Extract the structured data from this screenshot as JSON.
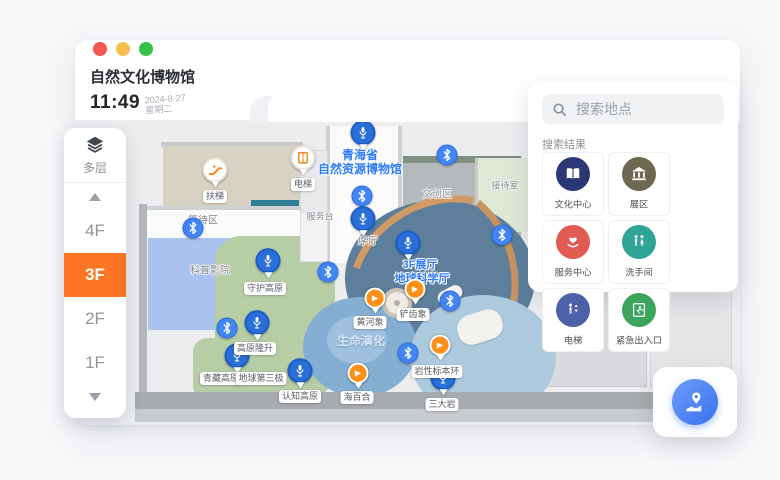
{
  "window": {
    "title": "自然文化博物馆",
    "time": "11:49",
    "date": "2024-8-27",
    "weekday": "星期二"
  },
  "floor_selector": {
    "layers_label": "多层",
    "floors": [
      "4F",
      "3F",
      "2F",
      "1F"
    ],
    "active_floor": "3F",
    "ghost_floor": "2F",
    "active_color": "#fd7522"
  },
  "search": {
    "placeholder": "搜索地点",
    "results_label": "搜索结果",
    "categories": [
      {
        "label": "文化中心",
        "icon": "book-icon",
        "color": "#2a3875"
      },
      {
        "label": "展区",
        "icon": "museum-icon",
        "color": "#6e6852"
      },
      {
        "label": "服务中心",
        "icon": "heart-hands-icon",
        "color": "#e25b52"
      },
      {
        "label": "洗手间",
        "icon": "restroom-icon",
        "color": "#2fa497"
      },
      {
        "label": "电梯",
        "icon": "elevator-icon",
        "color": "#4c61a8"
      },
      {
        "label": "紧急出入口",
        "icon": "emergency-exit-icon",
        "color": "#3da55b"
      }
    ]
  },
  "map": {
    "building_title": [
      "青海省",
      "自然资源博物馆"
    ],
    "hall_title": [
      "3F展厅",
      "地球科学厅"
    ],
    "area_life_evolution": "生命演化",
    "rooms": {
      "waiting": "等待区",
      "cinema": "科普影院",
      "service_desk": "服务台",
      "lobby": "序厅",
      "cultural_zone": "文创区",
      "reception": "接待室"
    },
    "pins": {
      "escalator": "扶梯",
      "elevator": "电梯",
      "guard_plateau": "守护高原",
      "plateau_uplift": "高原隆升",
      "tibet_plateau": "青藏高原",
      "third_pole": "地球第三极",
      "cognition_plateau": "认知高原",
      "yellow_river_elephant": "黄河象",
      "shovel_tusker": "铲齿象",
      "sea_lily": "海百合",
      "rock_specimen_ring": "岩性标本环",
      "three_rocks": "三大岩"
    },
    "icon_legend": {
      "audio": "microphone-icon",
      "video": "play-icon",
      "beacon": "bluetooth-icon"
    },
    "colors": {
      "beacon": "#4285f4",
      "audio_pin": "#2a6fd8",
      "video_pin": "#ff9015"
    }
  },
  "locate_button": {
    "icon": "map-pin-icon"
  }
}
